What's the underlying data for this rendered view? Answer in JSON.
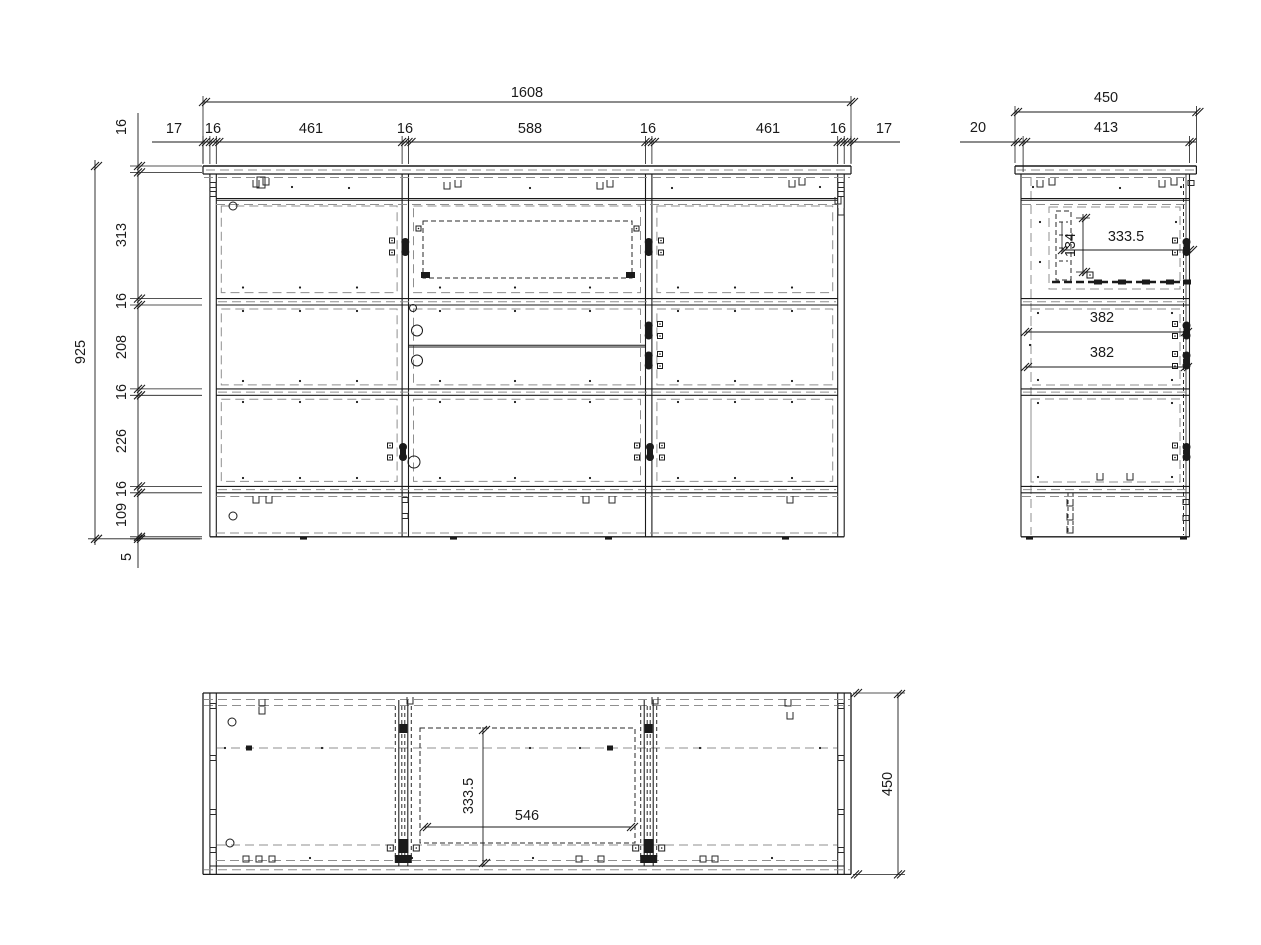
{
  "drawing": {
    "type": "furniture-technical-drawing",
    "views": {
      "front": "front-elevation",
      "side": "side-section",
      "bottom": "plan-view"
    }
  },
  "colors": {
    "line": "#1a1a1a",
    "dash_gray": "#8f8f8f",
    "dash_dark": "#2a2a2a"
  },
  "dims": {
    "front": [
      {
        "name": "overall-width",
        "text": "1608",
        "x": 527,
        "y": 92,
        "rot": 0
      },
      {
        "name": "overhang-left",
        "text": "17",
        "x": 174,
        "y": 128,
        "rot": 0
      },
      {
        "name": "panel-left",
        "text": "16",
        "x": 213,
        "y": 128,
        "rot": 0
      },
      {
        "name": "bay-left",
        "text": "461",
        "x": 311,
        "y": 128,
        "rot": 0
      },
      {
        "name": "divider-left",
        "text": "16",
        "x": 405,
        "y": 128,
        "rot": 0
      },
      {
        "name": "bay-middle",
        "text": "588",
        "x": 530,
        "y": 128,
        "rot": 0
      },
      {
        "name": "divider-right",
        "text": "16",
        "x": 648,
        "y": 128,
        "rot": 0
      },
      {
        "name": "bay-right",
        "text": "461",
        "x": 768,
        "y": 128,
        "rot": 0
      },
      {
        "name": "panel-right",
        "text": "16",
        "x": 838,
        "y": 128,
        "rot": 0
      },
      {
        "name": "overhang-right",
        "text": "17",
        "x": 884,
        "y": 128,
        "rot": 0
      },
      {
        "name": "top-thickness",
        "text": "16",
        "x": 121,
        "y": 127,
        "rot": -90
      },
      {
        "name": "overall-height",
        "text": "925",
        "x": 80,
        "y": 352,
        "rot": -90
      },
      {
        "name": "row1-height",
        "text": "313",
        "x": 121,
        "y": 235,
        "rot": -90
      },
      {
        "name": "shelf1",
        "text": "16",
        "x": 121,
        "y": 301,
        "rot": -90
      },
      {
        "name": "row2-height",
        "text": "208",
        "x": 121,
        "y": 347,
        "rot": -90
      },
      {
        "name": "shelf2",
        "text": "16",
        "x": 121,
        "y": 392,
        "rot": -90
      },
      {
        "name": "row3-height",
        "text": "226",
        "x": 121,
        "y": 441,
        "rot": -90
      },
      {
        "name": "bottom-thickness",
        "text": "16",
        "x": 121,
        "y": 489,
        "rot": -90
      },
      {
        "name": "plinth-height",
        "text": "109",
        "x": 121,
        "y": 515,
        "rot": -90
      },
      {
        "name": "floor-gap",
        "text": "5",
        "x": 126,
        "y": 557,
        "rot": -90
      }
    ],
    "side": [
      {
        "name": "overall-depth",
        "text": "450",
        "x": 1106,
        "y": 97,
        "rot": 0
      },
      {
        "name": "body-depth",
        "text": "413",
        "x": 1106,
        "y": 127,
        "rot": 0
      },
      {
        "name": "front-offset",
        "text": "20",
        "x": 978,
        "y": 127,
        "rot": 0
      },
      {
        "name": "drawer-depth",
        "text": "333.5",
        "x": 1126,
        "y": 236,
        "rot": 0
      },
      {
        "name": "drawer-height",
        "text": "134",
        "x": 1070,
        "y": 245,
        "rot": -90
      },
      {
        "name": "runner-top",
        "text": "382",
        "x": 1102,
        "y": 317,
        "rot": 0
      },
      {
        "name": "runner-bottom",
        "text": "382",
        "x": 1102,
        "y": 352,
        "rot": 0
      }
    ],
    "bottom": [
      {
        "name": "drawer-depth",
        "text": "333.5",
        "x": 468,
        "y": 796,
        "rot": -90
      },
      {
        "name": "drawer-width",
        "text": "546",
        "x": 527,
        "y": 815,
        "rot": 0
      },
      {
        "name": "overall-depth",
        "text": "450",
        "x": 887,
        "y": 784,
        "rot": -90
      }
    ]
  }
}
